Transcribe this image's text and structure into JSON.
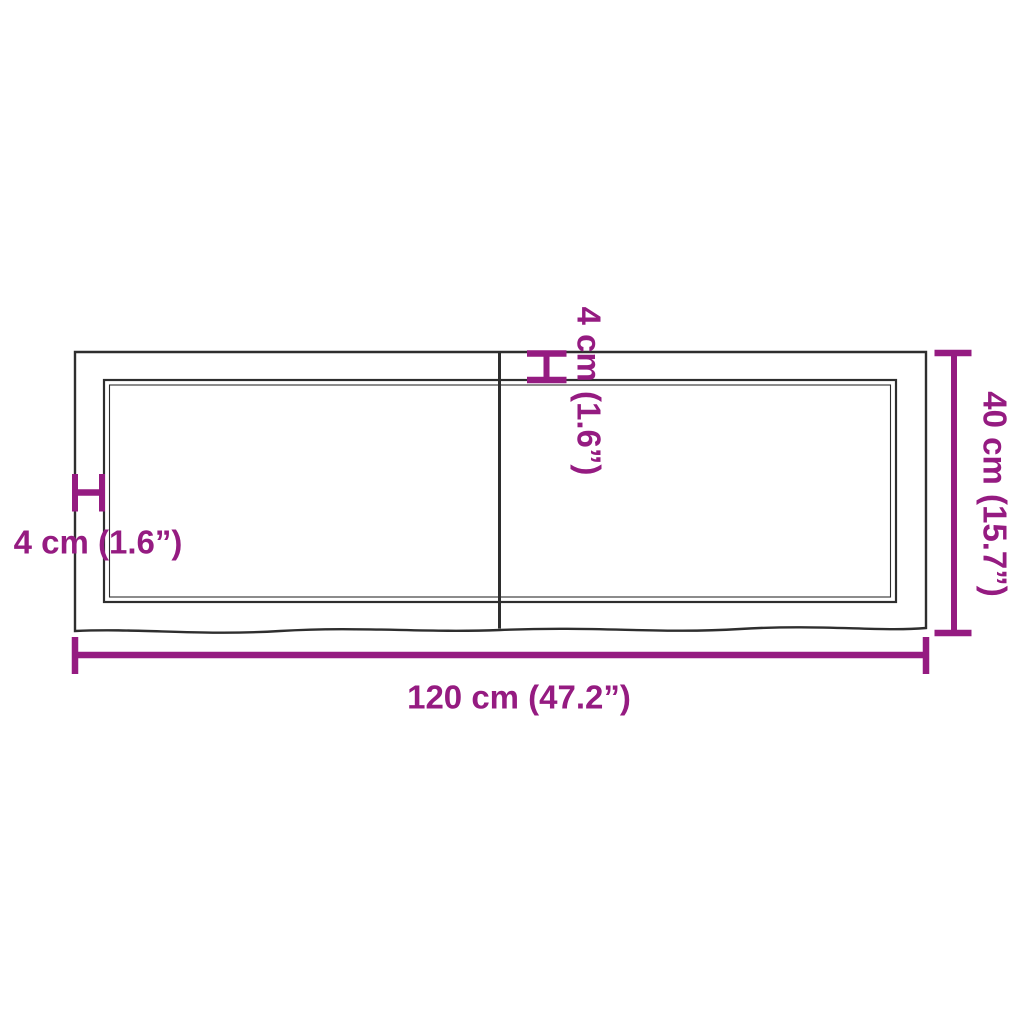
{
  "diagram": {
    "colors": {
      "accent": "#951b81",
      "line": "#2e2e2e",
      "bg": "#ffffff"
    },
    "dimensions": {
      "width_label": "120 cm (47.2”)",
      "height_label": "40 cm (15.7”)",
      "thickness_left_label": "4 cm (1.6”)",
      "thickness_top_label": "4 cm (1.6”)"
    }
  }
}
